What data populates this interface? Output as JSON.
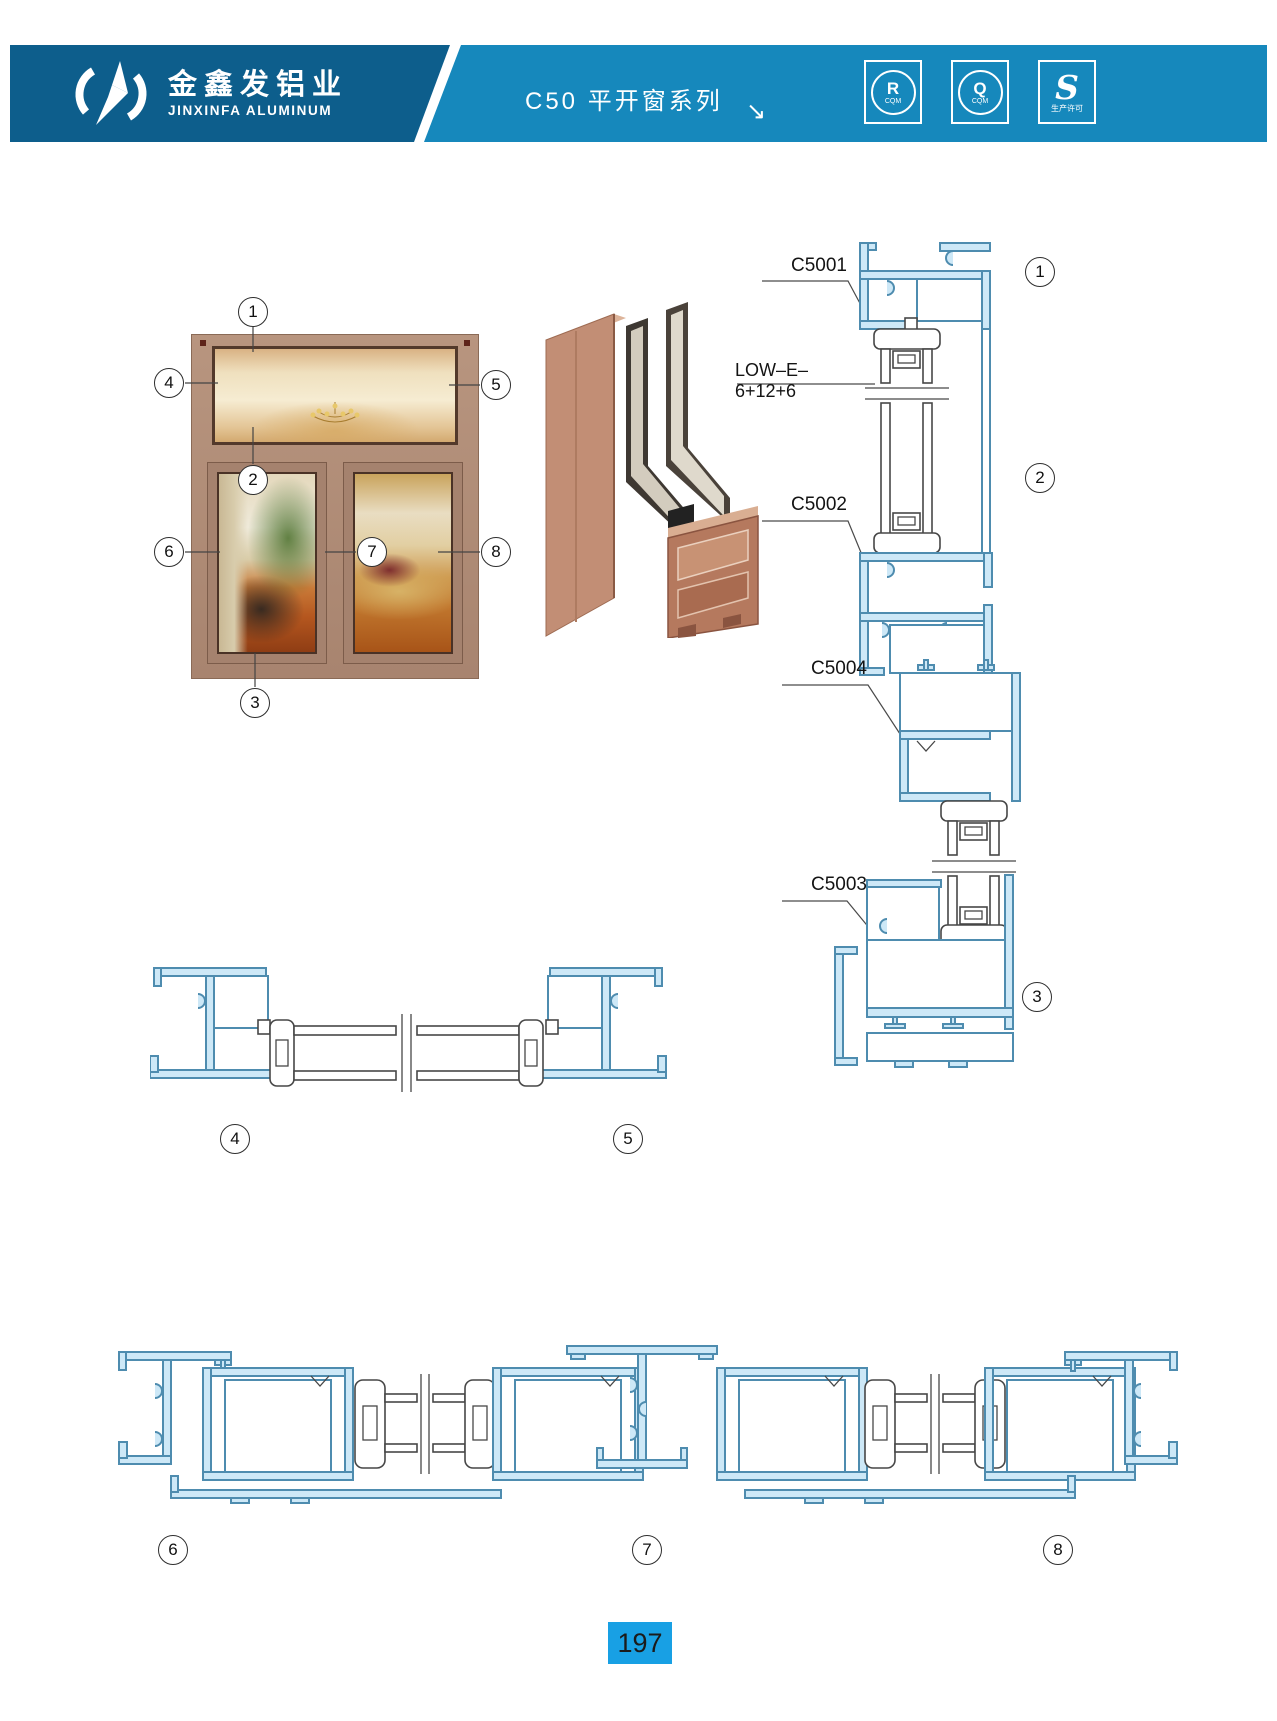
{
  "header": {
    "brand_cn": "金鑫发铝业",
    "brand_en": "JINXINFA ALUMINUM",
    "series_title": "C50 平开窗系列",
    "arrow_glyph": "↘",
    "badges": [
      {
        "symbol": "R",
        "caption": "CQM"
      },
      {
        "symbol": "Q",
        "caption": "CQM"
      },
      {
        "symbol": "S",
        "caption": "生产许可"
      }
    ]
  },
  "labels": {
    "head_profile": "C5001",
    "glazing": "LOW–E–6+12+6",
    "transom_profile": "C5002",
    "sash_profile": "C5004",
    "sill_profile": "C5003"
  },
  "callouts": {
    "n1": "1",
    "n2": "2",
    "n3": "3",
    "n4": "4",
    "n5": "5",
    "n6": "6",
    "n7": "7",
    "n8": "8"
  },
  "footer": {
    "page_number": "197"
  },
  "colors": {
    "header_left_bg": "#0D5E8C",
    "header_right_bg": "#1688BC",
    "page_number_bg": "#18A0E4",
    "drawing_stroke": "#4E8CAF",
    "drawing_fill": "#CDE8F7",
    "frame_brown": "#A8846F"
  }
}
